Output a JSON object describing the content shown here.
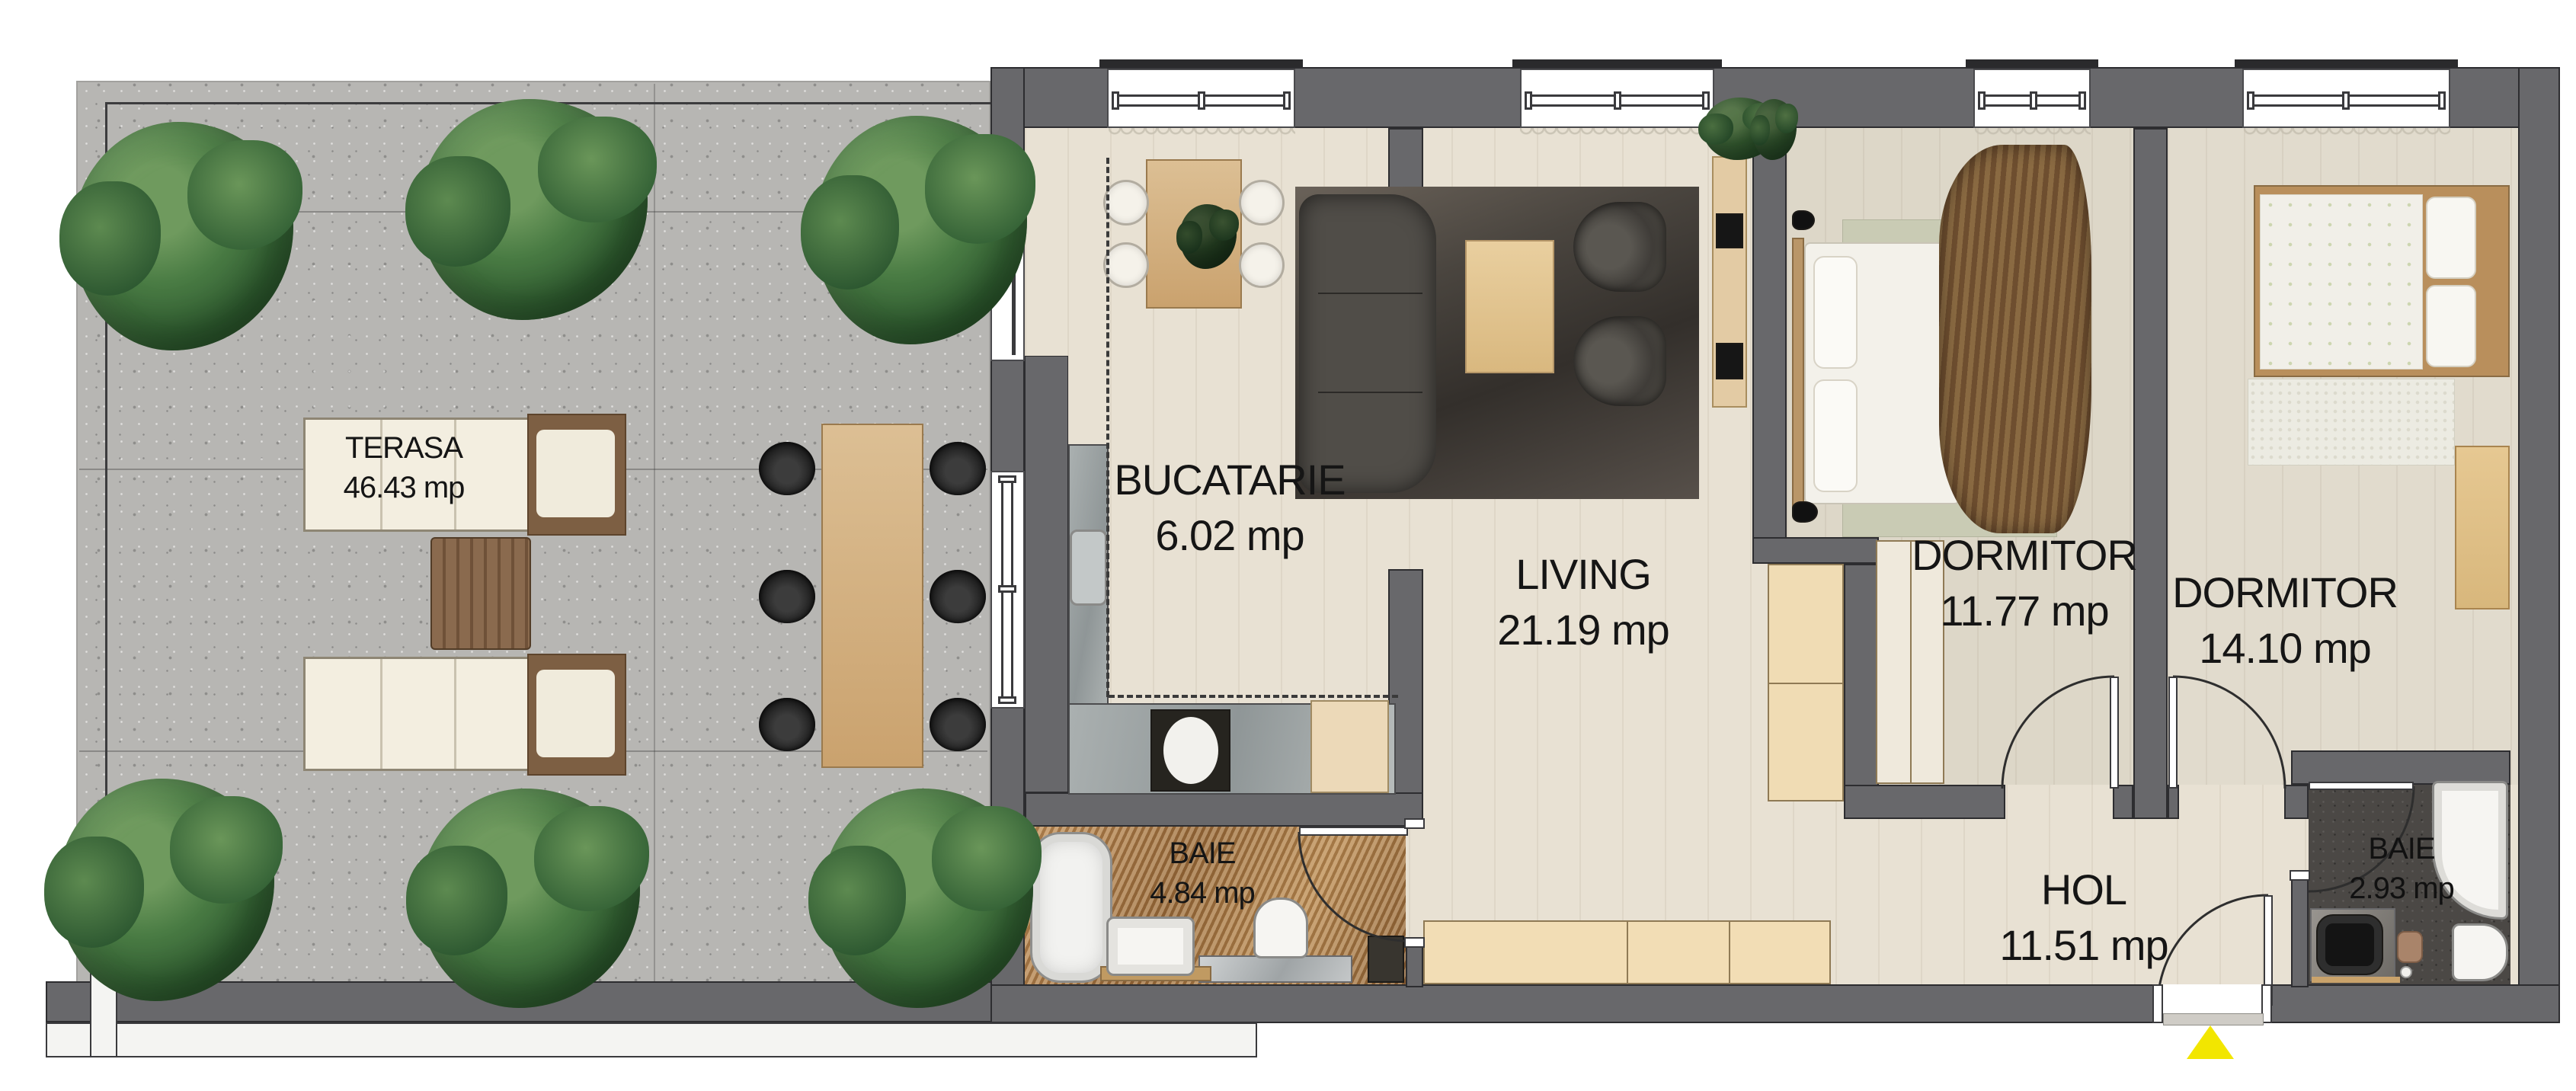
{
  "rooms": {
    "terasa": {
      "name": "TERASA",
      "area": "46.43 mp"
    },
    "bucatarie": {
      "name": "BUCATARIE",
      "area": "6.02 mp"
    },
    "living": {
      "name": "LIVING",
      "area": "21.19 mp"
    },
    "dormitor1": {
      "name": "DORMITOR",
      "area": "11.77 mp"
    },
    "dormitor2": {
      "name": "DORMITOR",
      "area": "14.10 mp"
    },
    "baie1": {
      "name": "BAIE",
      "area": "4.84 mp"
    },
    "hol": {
      "name": "HOL",
      "area": "11.51 mp"
    },
    "baie2": {
      "name": "BAIE",
      "area": "2.93 mp"
    }
  },
  "colors": {
    "wall": "#68686b",
    "entrance_arrow": "#f2e600",
    "plant_green": "#3c6b39",
    "concrete": "#b7b6b3",
    "warm_wood_tile": "#a8793f",
    "dark_tile": "#4b4845"
  }
}
